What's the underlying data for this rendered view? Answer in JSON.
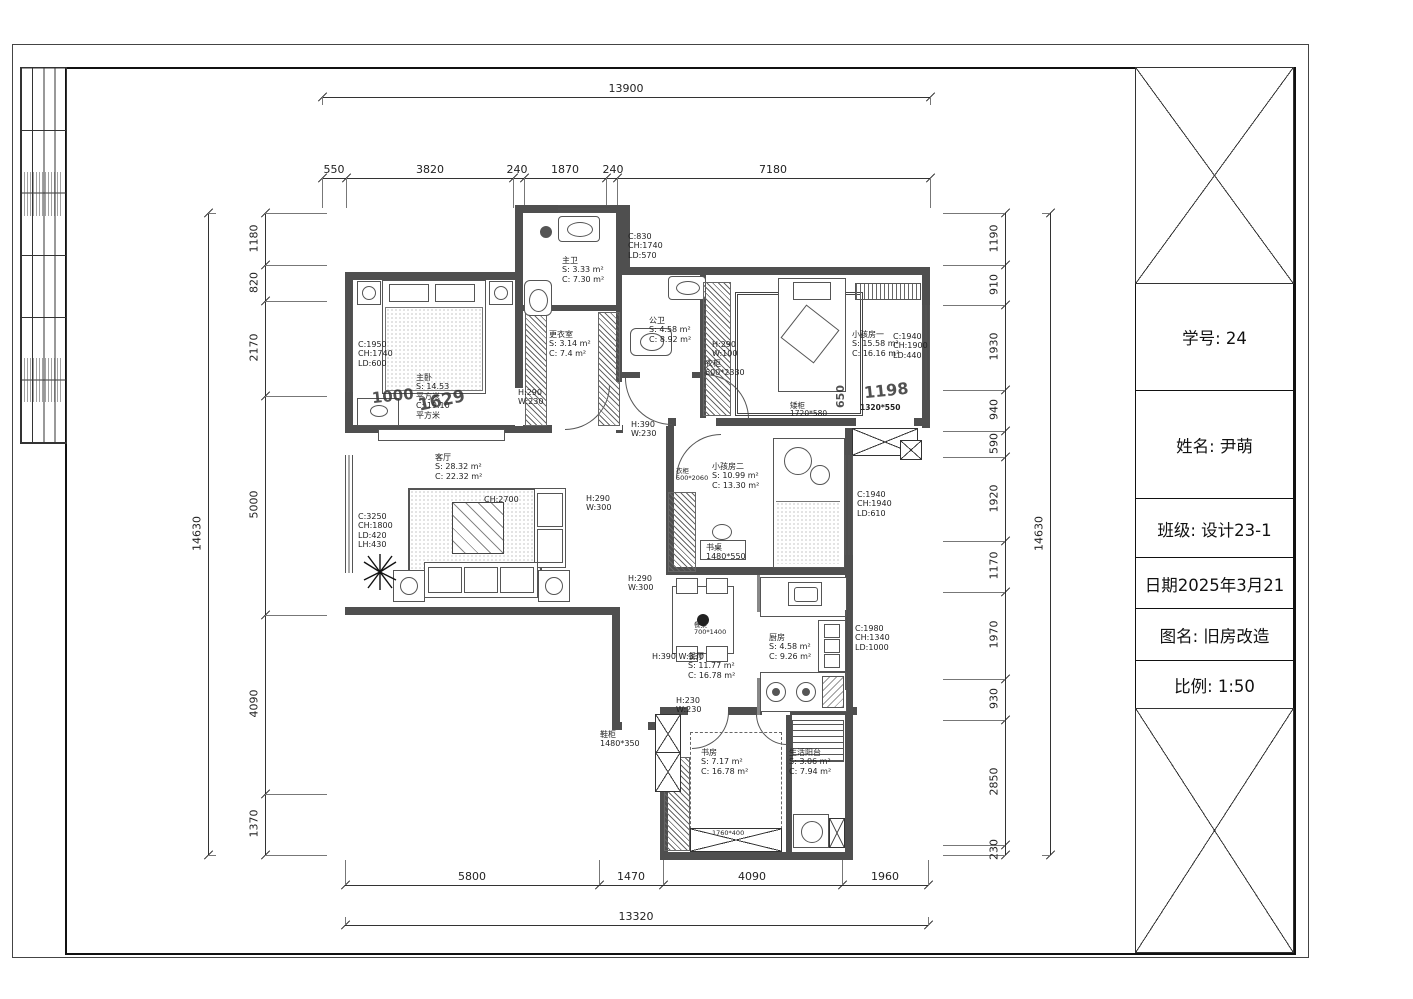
{
  "title_block": {
    "student_id": "学号: 24",
    "name": "姓名: 尹萌",
    "class": "班级: 设计23-1",
    "date": "日期2025年3月21",
    "drawing_name": "图名: 旧房改造",
    "scale": "比例: 1:50"
  },
  "dims": {
    "top": {
      "overall": "13900",
      "segments": [
        "550",
        "3820",
        "240",
        "1870",
        "240",
        "7180"
      ]
    },
    "left": {
      "overall": "14630",
      "segments": [
        "1180",
        "820",
        "2170",
        "5000",
        "4090",
        "1370"
      ]
    },
    "right": {
      "overall": "14630",
      "segments": [
        "1190",
        "910",
        "1930",
        "940",
        "590",
        "1920",
        "1170",
        "1970",
        "930",
        "2850",
        "230"
      ]
    },
    "bottom": {
      "overall": "13320",
      "segments": [
        "5800",
        "1470",
        "4090",
        "1960"
      ]
    },
    "inner": {
      "d1000": "1000",
      "d1629": "1629",
      "d1198": "1198",
      "d650": "650"
    }
  },
  "rooms": {
    "master": "主卧\nS: 14.53\n平方米\nC: 19.10\n平方米",
    "master_bath": "主卫\nS: 3.33 m²\nC: 7.30 m²",
    "cloakroom": "更衣室\nS: 3.14 m²\nC: 7.4 m²",
    "guest_bath": "公卫\nS: 4.58 m²\nC: 8.92 m²",
    "kids1": "小孩房一\nS: 15.58 m²\nC: 16.16 m²",
    "kids2": "小孩房二\nS: 10.99 m²\nC: 13.30 m²",
    "living": "客厅\nS: 28.32 m²\nC: 22.32 m²",
    "dining": "餐厅\nS: 11.77 m²\nC: 16.78 m²",
    "kitchen": "厨房\nS: 4.58 m²\nC: 9.26 m²",
    "study": "书房\nS: 7.17 m²\nC: 16.78 m²",
    "balcony": "生活阳台\nS: 3.06 m²\nC: 7.94 m²"
  },
  "windows": {
    "master": "C:1950\nCH:1740\nLD:600",
    "bath_top": "C:830\nCH:1740\nLD:570",
    "kids1": "C:1940\nCH:1900\nLD:440",
    "kids2": "C:1940\nCH:1940\nLD:610",
    "kitchen": "C:1980\nCH:1340\nLD:1000",
    "living": "C:3250\nCH:1800\nLD:420\nLH:430",
    "living_ch": "CH:2700"
  },
  "doors": {
    "master": "H:290\nW:230",
    "hall_wardrobe": "H:290\nW:100",
    "kids2_top": "H:390\nW:230",
    "living_pass": "H:290\nW:300",
    "dining_pass": "H:290\nW:300",
    "dining": "H:390 W:330",
    "study": "H:230\nW:230"
  },
  "furniture": {
    "desk": "书桌\n1480*550",
    "dining_table": "餐桌\n700*1400",
    "wardrobe_hall": "衣柜\n600*2330",
    "wardrobe_kids2": "衣柜\n500*2060",
    "low_cabinet": "矮柜\n1720*580",
    "cabinet_1320": "1320*550",
    "shoe_cabinet": "鞋柜\n1480*350",
    "study_cabinet": "1760*400"
  }
}
